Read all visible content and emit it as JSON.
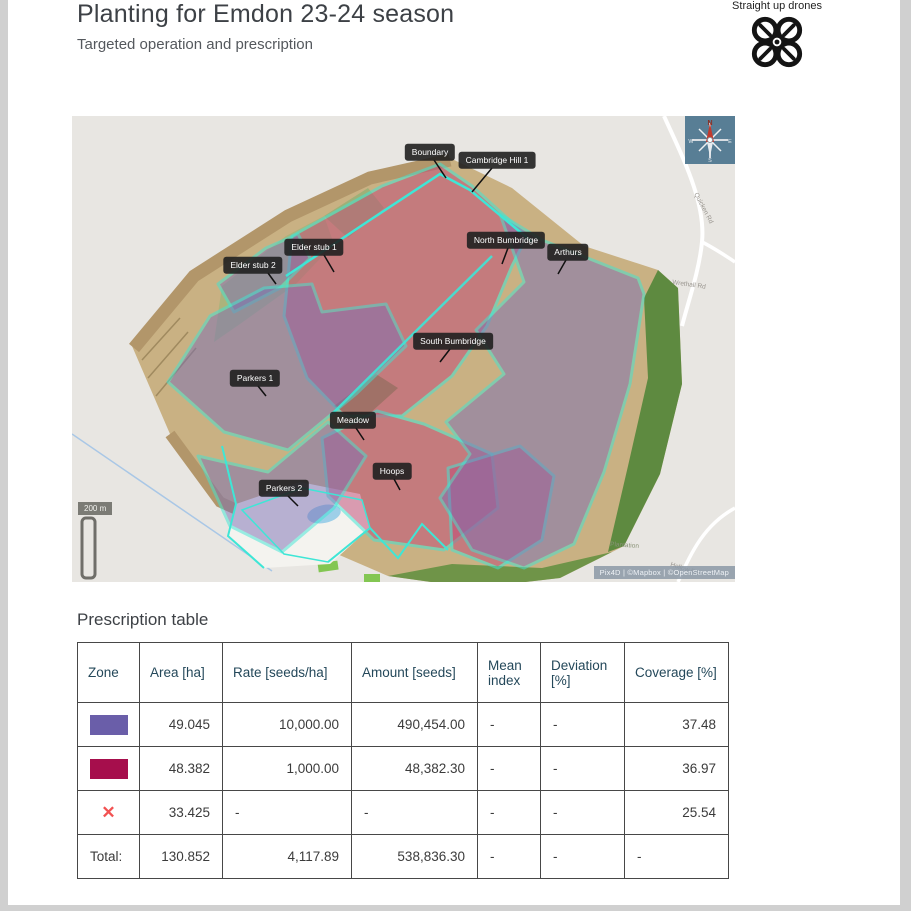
{
  "page": {
    "title": "Planting for Emdon 23-24 season",
    "subtitle": "Targeted operation and prescription"
  },
  "logo": {
    "caption": "Straight up drones"
  },
  "map": {
    "zone_labels": [
      {
        "name": "Boundary"
      },
      {
        "name": "Cambridge Hill 1"
      },
      {
        "name": "Elder stub 1"
      },
      {
        "name": "Elder stub 2"
      },
      {
        "name": "North Bumbridge"
      },
      {
        "name": "Arthurs"
      },
      {
        "name": "South Bumbridge"
      },
      {
        "name": "Parkers 1"
      },
      {
        "name": "Meadow"
      },
      {
        "name": "Hoops"
      },
      {
        "name": "Parkers 2"
      }
    ],
    "road_labels": [
      {
        "name": "Quicken Rd"
      },
      {
        "name": "Wrethall Rd"
      },
      {
        "name": "Hollow Rd"
      },
      {
        "name": "Plantation"
      }
    ],
    "compass": {
      "n": "N",
      "e": "E",
      "s": "S",
      "w": "W"
    },
    "scale_label": "200 m",
    "attribution": "Pix4D | ©Mapbox | ©OpenStreetMap",
    "colors": {
      "zone_outline": "#3ee6d6",
      "zone_pink": "#c14b78",
      "zone_purple": "#7b6fb5"
    }
  },
  "table": {
    "heading": "Prescription table",
    "columns": [
      "Zone",
      "Area [ha]",
      "Rate [seeds/ha]",
      "Amount [seeds]",
      "Mean index",
      "Deviation [%]",
      "Coverage [%]"
    ],
    "rows": [
      {
        "swatch": "#6a5ea9",
        "area": "49.045",
        "rate": "10,000.00",
        "amount": "490,454.00",
        "mean": "-",
        "deviation": "-",
        "coverage": "37.48"
      },
      {
        "swatch": "#a60e4c",
        "area": "48.382",
        "rate": "1,000.00",
        "amount": "48,382.30",
        "mean": "-",
        "deviation": "-",
        "coverage": "36.97"
      },
      {
        "x_glyph": "✕",
        "area": "33.425",
        "rate": "-",
        "amount": "-",
        "mean": "-",
        "deviation": "-",
        "coverage": "25.54"
      }
    ],
    "total_row": {
      "label": "Total:",
      "area": "130.852",
      "rate": "4,117.89",
      "amount": "538,836.30",
      "mean": "-",
      "deviation": "-",
      "coverage": "-"
    }
  }
}
